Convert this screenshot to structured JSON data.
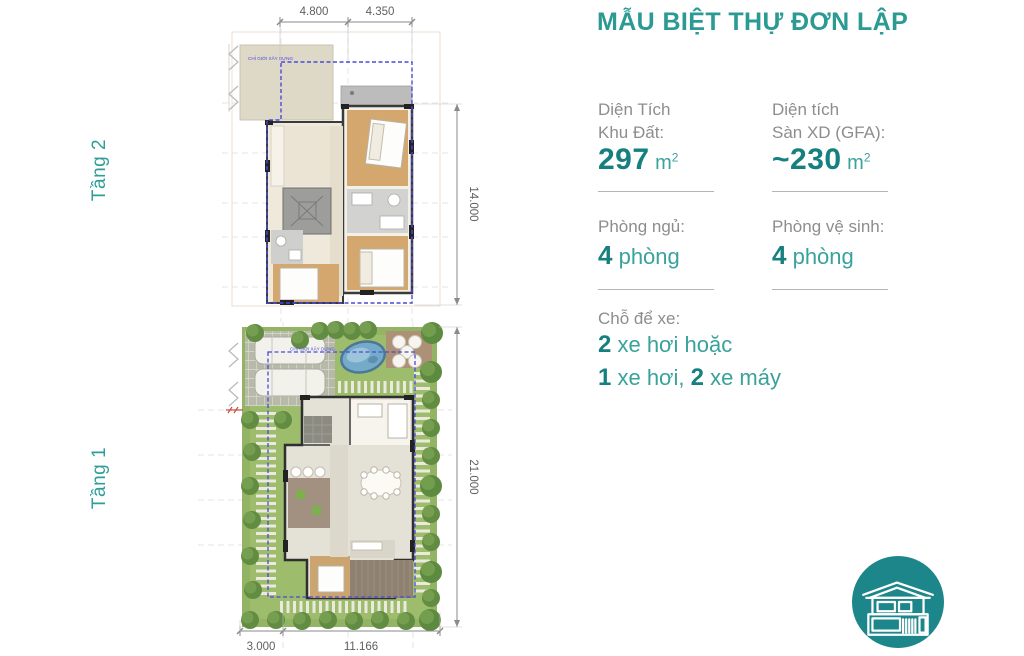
{
  "header": {
    "title": "MẪU BIỆT THỰ ĐƠN LẬP"
  },
  "floors": [
    {
      "label": "Tầng 2",
      "top_dims": [
        "4.800",
        "4.350"
      ],
      "right_dim": "14.000",
      "boundary_note": "CHỈ GIỚI XÂY DỰNG"
    },
    {
      "label": "Tầng 1",
      "bottom_dims": [
        "3.000",
        "11.166"
      ],
      "right_dim": "21.000",
      "boundary_note": "CHỈ GIỚI XÂY DỰNG"
    }
  ],
  "stats": {
    "land_area": {
      "label_line1": "Diện Tích",
      "label_line2": "Khu Đất:",
      "value": "297",
      "unit": "m",
      "unit_exp": "2"
    },
    "gfa": {
      "label_line1": "Diện tích",
      "label_line2": "Sàn XD (GFA):",
      "value": "~230",
      "unit": "m",
      "unit_exp": "2"
    },
    "bedrooms": {
      "label": "Phòng ngủ:",
      "value": "4",
      "unit": " phòng"
    },
    "bathrooms": {
      "label": "Phòng vệ sinh:",
      "value": "4",
      "unit": " phòng"
    },
    "parking": {
      "label": "Chỗ để xe:",
      "line1_value": "2",
      "line1_text": " xe hơi hoặc",
      "line2_value1": "1",
      "line2_text1": " xe hơi, ",
      "line2_value2": "2",
      "line2_text2": " xe máy"
    }
  },
  "icon": {
    "name": "villa-icon"
  },
  "colors": {
    "teal_title": "#2a9a93",
    "teal_number": "#15807f",
    "teal_word": "#3aa29c",
    "gray_label": "#8d8d8d",
    "divider": "#b5b5b5",
    "dimension_text": "#5f5f5f",
    "boundary_dash": "#4a4ad9",
    "icon_circle": "#1d868a"
  }
}
